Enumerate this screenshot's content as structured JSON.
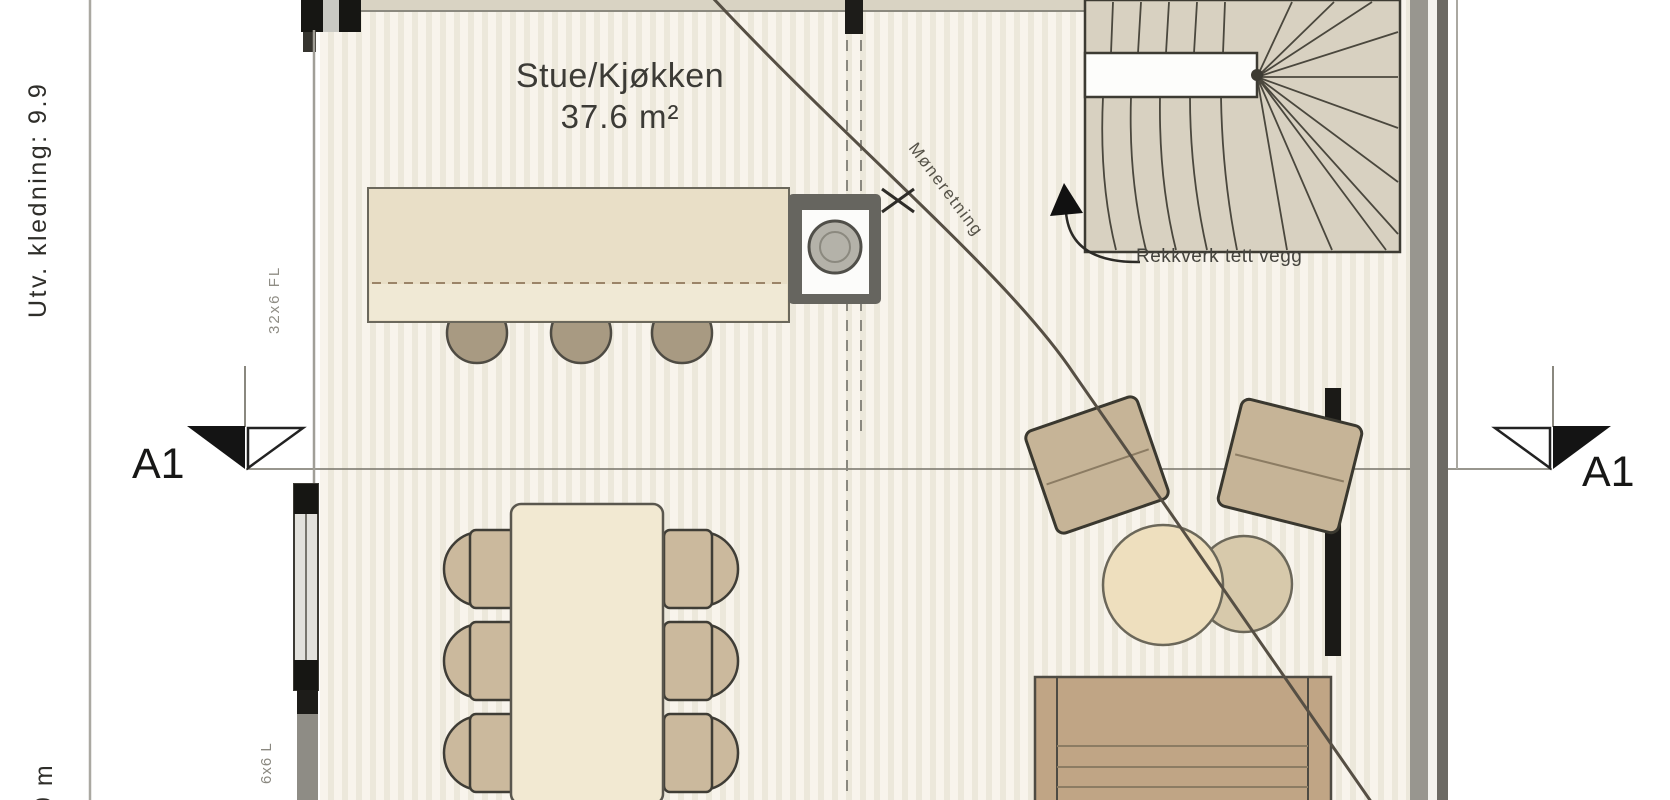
{
  "room": {
    "name": "Stue/Kjøkken",
    "area": "37.6 m²"
  },
  "labels": {
    "cladding_side": "Utv. kledning: 9.9",
    "cladding_bottom": "9 m",
    "ridge_direction": "Møneretning",
    "railing_note": "Rekkverk tett vegg",
    "wall_note_upper": "32x6 FL",
    "wall_note_lower": "6x6 L",
    "section_marker_left": "A1",
    "section_marker_right": "A1"
  },
  "colors": {
    "floor_stripe_light": "#f8f4ec",
    "floor_stripe_dark": "#ece8db",
    "wall_tan": "#d9d3c3",
    "wall_gray": "#98968f",
    "stair_fill": "#d8d1c1",
    "counter_fill": "#e9dfc7",
    "table_fill": "#f2e9d2",
    "chair_fill": "#cbb99d",
    "sofa_fill": "#c0a585",
    "line_dark": "#3d3b33"
  }
}
